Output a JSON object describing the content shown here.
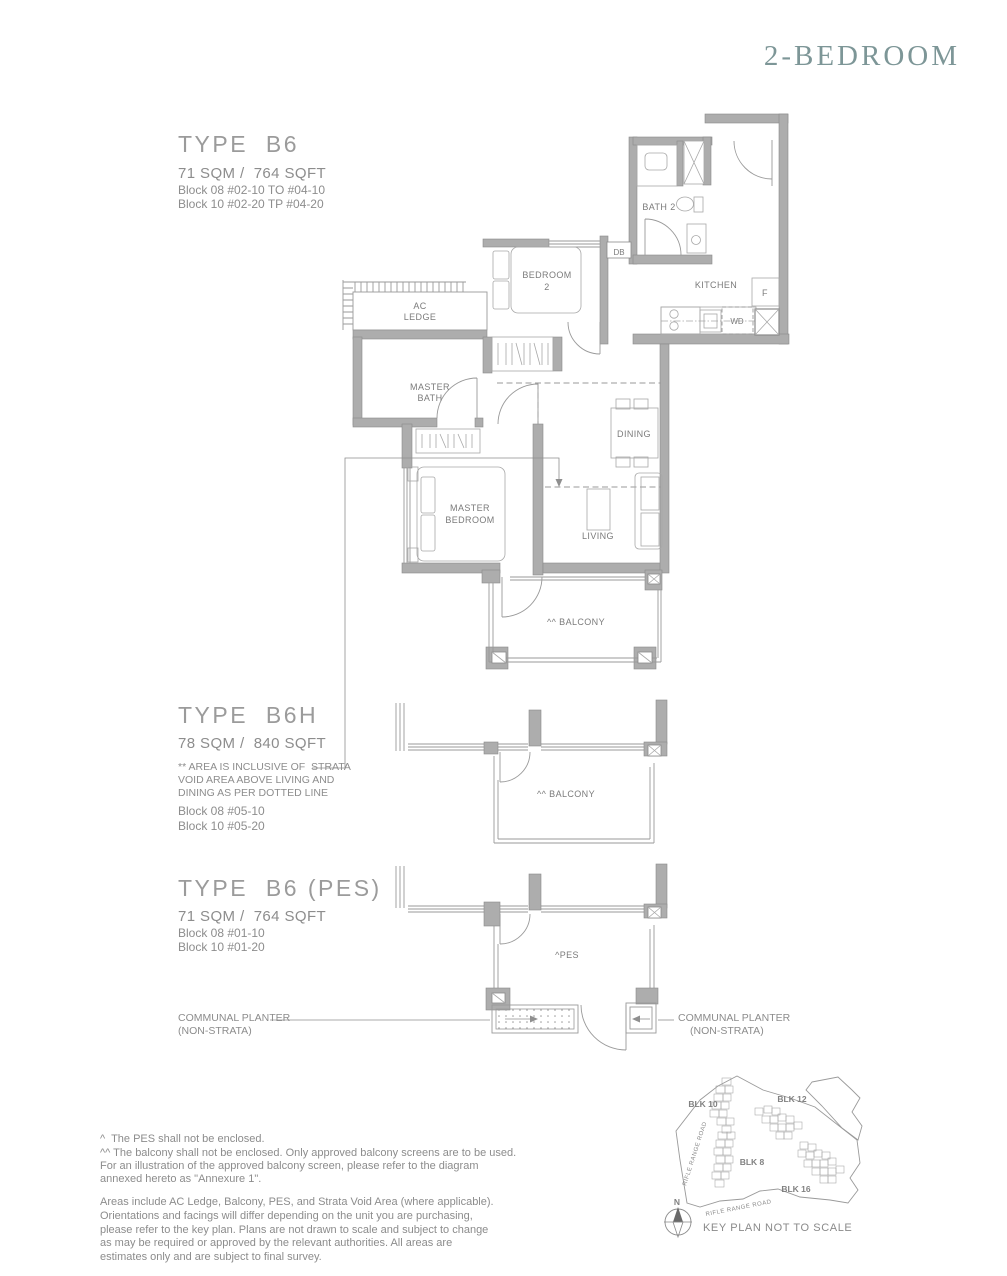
{
  "header": {
    "title": "2-BEDROOM"
  },
  "sections": {
    "b6": {
      "heading": "TYPE  B6",
      "area": "71 SQM /  764 SQFT",
      "block1": "Block 08 #02-10 TO #04-10",
      "block2": "Block 10 #02-20 TP #04-20"
    },
    "b6h": {
      "heading": "TYPE  B6H",
      "area": "78 SQM /  840 SQFT",
      "note1": "** AREA IS INCLUSIVE OF  STRATA",
      "note2": "VOID AREA ABOVE LIVING AND",
      "note3": "DINING AS PER DOTTED LINE",
      "block1": "Block 08 #05-10",
      "block2": "Block 10 #05-20"
    },
    "b6pes": {
      "heading": "TYPE  B6 (PES)",
      "area": "71 SQM /  764 SQFT",
      "block1": "Block 08 #01-10",
      "block2": "Block 10 #01-20"
    }
  },
  "plan": {
    "bath2": "BATH 2",
    "db": "DB",
    "kitchen": "KITCHEN",
    "fridge": "F",
    "washer": "WD",
    "ac1": "AC",
    "ac2": "LEDGE",
    "bedroom2_1": "BEDROOM",
    "bedroom2_2": "2",
    "mbath1": "MASTER",
    "mbath2": "BATH",
    "dining": "DINING",
    "mbed1": "MASTER",
    "mbed2": "BEDROOM",
    "living": "LIVING",
    "balcony": "^^ BALCONY",
    "balcony_h": "^^ BALCONY",
    "pes": "^PES"
  },
  "planters": {
    "left1": "COMMUNAL PLANTER",
    "left2": "(NON-STRATA)",
    "right1": "COMMUNAL PLANTER",
    "right2": "(NON-STRATA)"
  },
  "footnotes": {
    "line1": "^  The PES shall not be enclosed.",
    "line2": "^^ The balcony shall not be enclosed. Only approved balcony screens are to be used.",
    "line3": "For an illustration of the approved balcony screen, please refer to the diagram",
    "line4": "annexed hereto as \"Annexure 1\".",
    "para": "Areas include AC Ledge, Balcony, PES, and Strata Void Area (where applicable). Orientations and facings will differ depending on the unit you are purchasing, please refer to the key plan. Plans are not drawn to scale and subject to change as may be required or approved by the relevant authorities. All areas are estimates only and are subject to final survey."
  },
  "keyplan": {
    "blk10": "BLK 10",
    "blk12": "BLK 12",
    "blk8": "BLK 8",
    "blk16": "BLK 16",
    "road_left": "RIFLE RANGE ROAD",
    "road_bottom": "RIFLE RANGE ROAD",
    "north": "N",
    "caption": "KEY PLAN NOT TO SCALE"
  },
  "colors": {
    "title": "#7d9697",
    "heading": "#9b9b9b",
    "text": "#8d8d8d",
    "wall": "#adadad"
  }
}
